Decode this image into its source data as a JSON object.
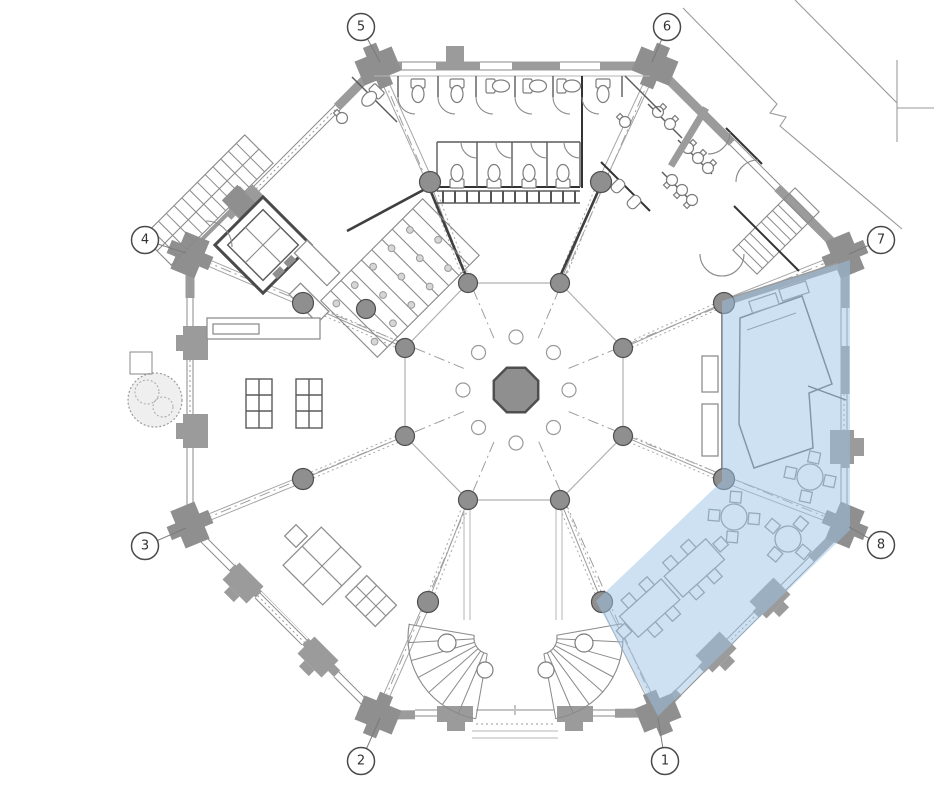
{
  "plan": {
    "colors": {
      "background": "#ffffff",
      "wall": "#9b9b9b",
      "pier": "#8f8f8f",
      "column_fill": "#8f8f8f",
      "column_stroke": "#4f4f4f",
      "grid_line": "#9e9e9e",
      "highlight": "#9cc4e8",
      "marker_stroke": "#4a4a4a",
      "marker_fill": "#ffffff",
      "marker_text": "#333333"
    },
    "octagon": {
      "cx": 516,
      "cy": 390,
      "corners": [
        [
          378,
          66
        ],
        [
          655,
          66
        ],
        [
          845,
          255
        ],
        [
          845,
          525
        ],
        [
          658,
          713
        ],
        [
          378,
          715
        ],
        [
          190,
          525
        ],
        [
          190,
          255
        ]
      ]
    },
    "bays": [
      {
        "corner": [
          378,
          66
        ],
        "outer": [
          430,
          182
        ],
        "inner": [
          468,
          283
        ]
      },
      {
        "corner": [
          655,
          66
        ],
        "outer": [
          601,
          182
        ],
        "inner": [
          560,
          283
        ]
      },
      {
        "corner": [
          845,
          255
        ],
        "outer": [
          724,
          303
        ],
        "inner": [
          623,
          348
        ]
      },
      {
        "corner": [
          845,
          525
        ],
        "outer": [
          724,
          479
        ],
        "inner": [
          623,
          436
        ]
      },
      {
        "corner": [
          658,
          713
        ],
        "outer": [
          602,
          602
        ],
        "inner": [
          560,
          500
        ]
      },
      {
        "corner": [
          378,
          715
        ],
        "outer": [
          428,
          602
        ],
        "inner": [
          468,
          500
        ]
      },
      {
        "corner": [
          190,
          525
        ],
        "outer": [
          303,
          479
        ],
        "inner": [
          405,
          436
        ]
      },
      {
        "corner": [
          190,
          255
        ],
        "outer": [
          303,
          303
        ],
        "inner": [
          405,
          348
        ]
      }
    ],
    "columns": {
      "outer_radius": 10.5,
      "inner_radius": 9.5,
      "extra": [
        [
          366,
          309
        ]
      ]
    },
    "atrium": {
      "small_circle_radius": 7,
      "small_circle_ring_radius": 53,
      "center_octagon_radius": 24
    },
    "highlight_region": {
      "opacity": 0.5,
      "points": [
        [
          722,
          301
        ],
        [
          850,
          260
        ],
        [
          850,
          530
        ],
        [
          658,
          716
        ],
        [
          596,
          601
        ],
        [
          722,
          481
        ]
      ]
    },
    "grid_markers": [
      {
        "label": "1",
        "cx": 665,
        "cy": 761,
        "tx": 658,
        "ty": 718
      },
      {
        "label": "2",
        "cx": 361,
        "cy": 761,
        "tx": 380,
        "ty": 718
      },
      {
        "label": "3",
        "cx": 145,
        "cy": 546,
        "tx": 186,
        "ty": 528
      },
      {
        "label": "4",
        "cx": 145,
        "cy": 240,
        "tx": 186,
        "ty": 253
      },
      {
        "label": "5",
        "cx": 361,
        "cy": 27,
        "tx": 380,
        "ty": 62
      },
      {
        "label": "6",
        "cx": 667,
        "cy": 27,
        "tx": 652,
        "ty": 62
      },
      {
        "label": "7",
        "cx": 881,
        "cy": 240,
        "tx": 849,
        "ty": 254
      },
      {
        "label": "8",
        "cx": 881,
        "cy": 545,
        "tx": 849,
        "ty": 527
      }
    ],
    "marker_radius": 13.5
  }
}
